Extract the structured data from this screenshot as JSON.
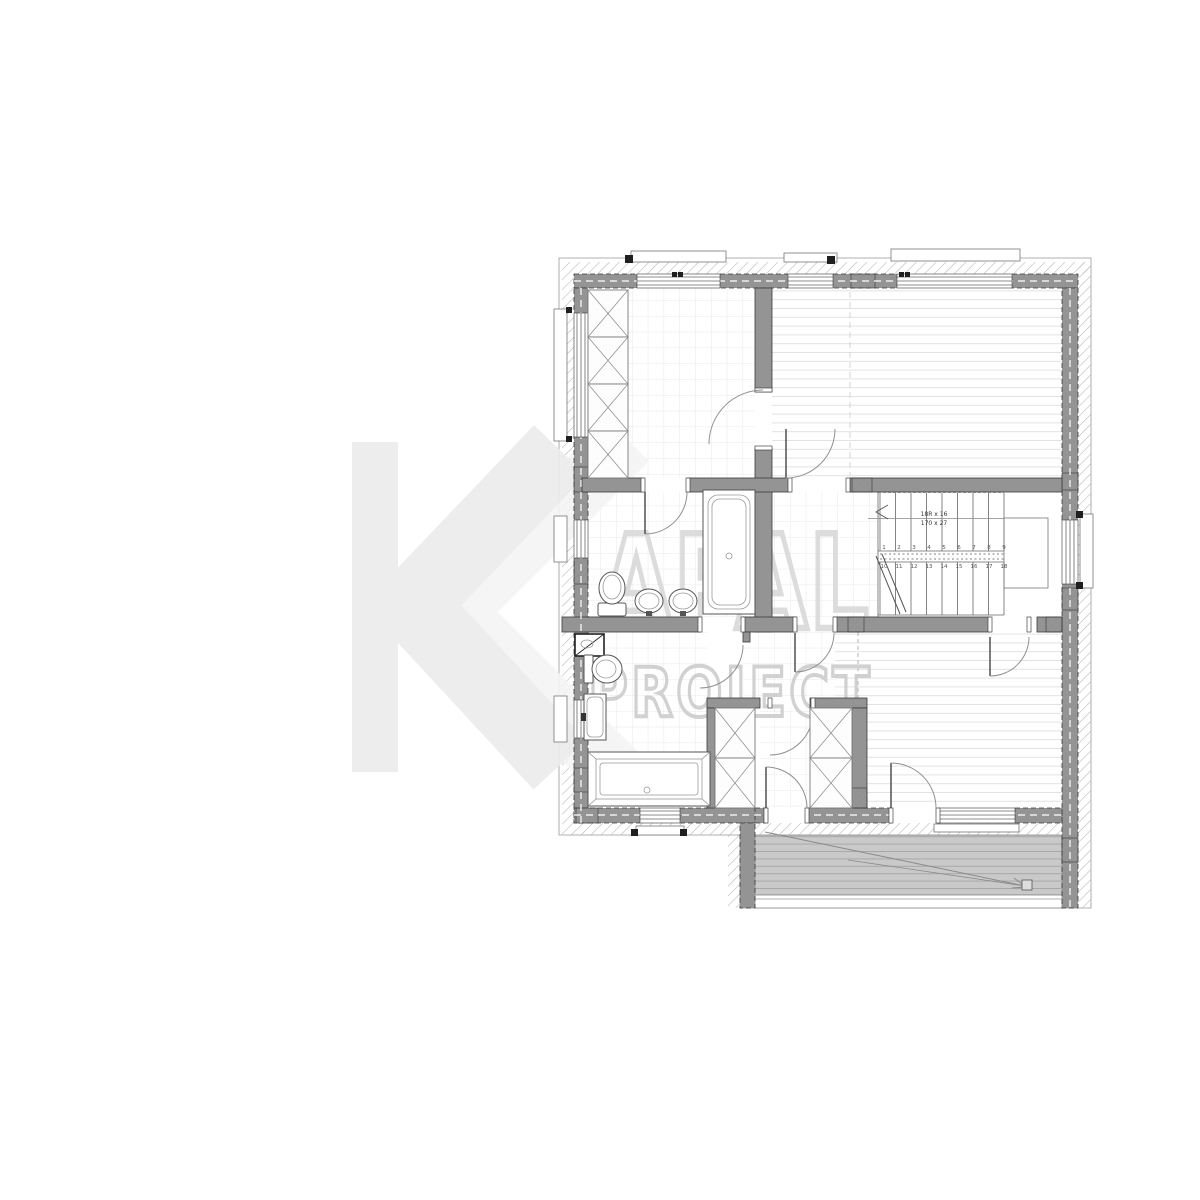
{
  "page": {
    "background": "#ffffff",
    "description": "Architectural floor plan drawing with watermark"
  },
  "watermark": {
    "letter_k": "K",
    "word": "APAL",
    "subtitle": "PROJECT",
    "k_color": "#ececec",
    "outline_color": "#d9d9d9",
    "subtitle_color": "#cdcdcd"
  },
  "stairs": {
    "note_line1": "18R x 16",
    "note_line2": "170 x 27",
    "tread_numbers_up": [
      "1",
      "2",
      "3",
      "4",
      "5",
      "6",
      "7",
      "8",
      "9"
    ],
    "tread_numbers_down": [
      "10",
      "11",
      "12",
      "13",
      "14",
      "15",
      "16",
      "17",
      "18"
    ]
  },
  "colors": {
    "wall": "#949494",
    "hatch": "#b4b4b4",
    "floor_grid": "#e9e9e9",
    "wood_lines": "#e2e2e2",
    "terrace_fill": "#c9c9c9",
    "terrace_lines": "#a8a8a8",
    "fixtures": "#555555"
  }
}
